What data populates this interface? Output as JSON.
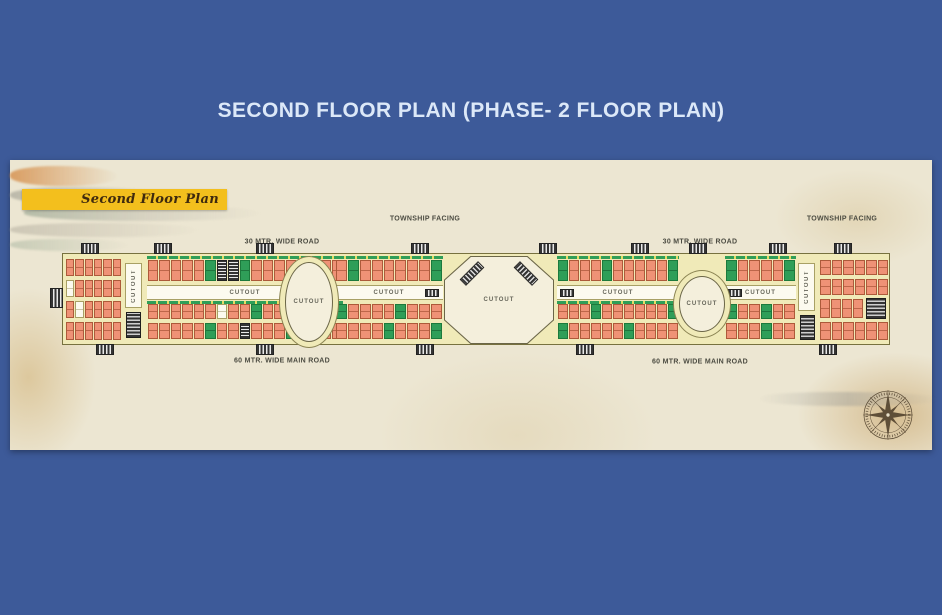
{
  "page": {
    "title": "SECOND FLOOR PLAN (PHASE- 2 FLOOR PLAN)"
  },
  "plan": {
    "banner_title": "Second Floor Plan",
    "labels": {
      "township_facing": "TOWNSHIP FACING",
      "road_30m": "30 MTR. WIDE ROAD",
      "road_60m": "60 MTR. WIDE MAIN ROAD",
      "cutout": "CUTOUT"
    },
    "colors": {
      "background_blue": "#3d5a99",
      "parchment": "#ece6d2",
      "banner_yellow": "#f3bf1d",
      "strip_background": "#f0eab8",
      "shop_unit": "#ef9276",
      "green_unit": "#2f9e58",
      "cutout_white": "#fcfaef",
      "core_dark": "#343434",
      "title_text": "#dce8f8"
    },
    "icons": {
      "compass": "compass-rose-icon",
      "stairs": "stair-block-icon"
    }
  }
}
